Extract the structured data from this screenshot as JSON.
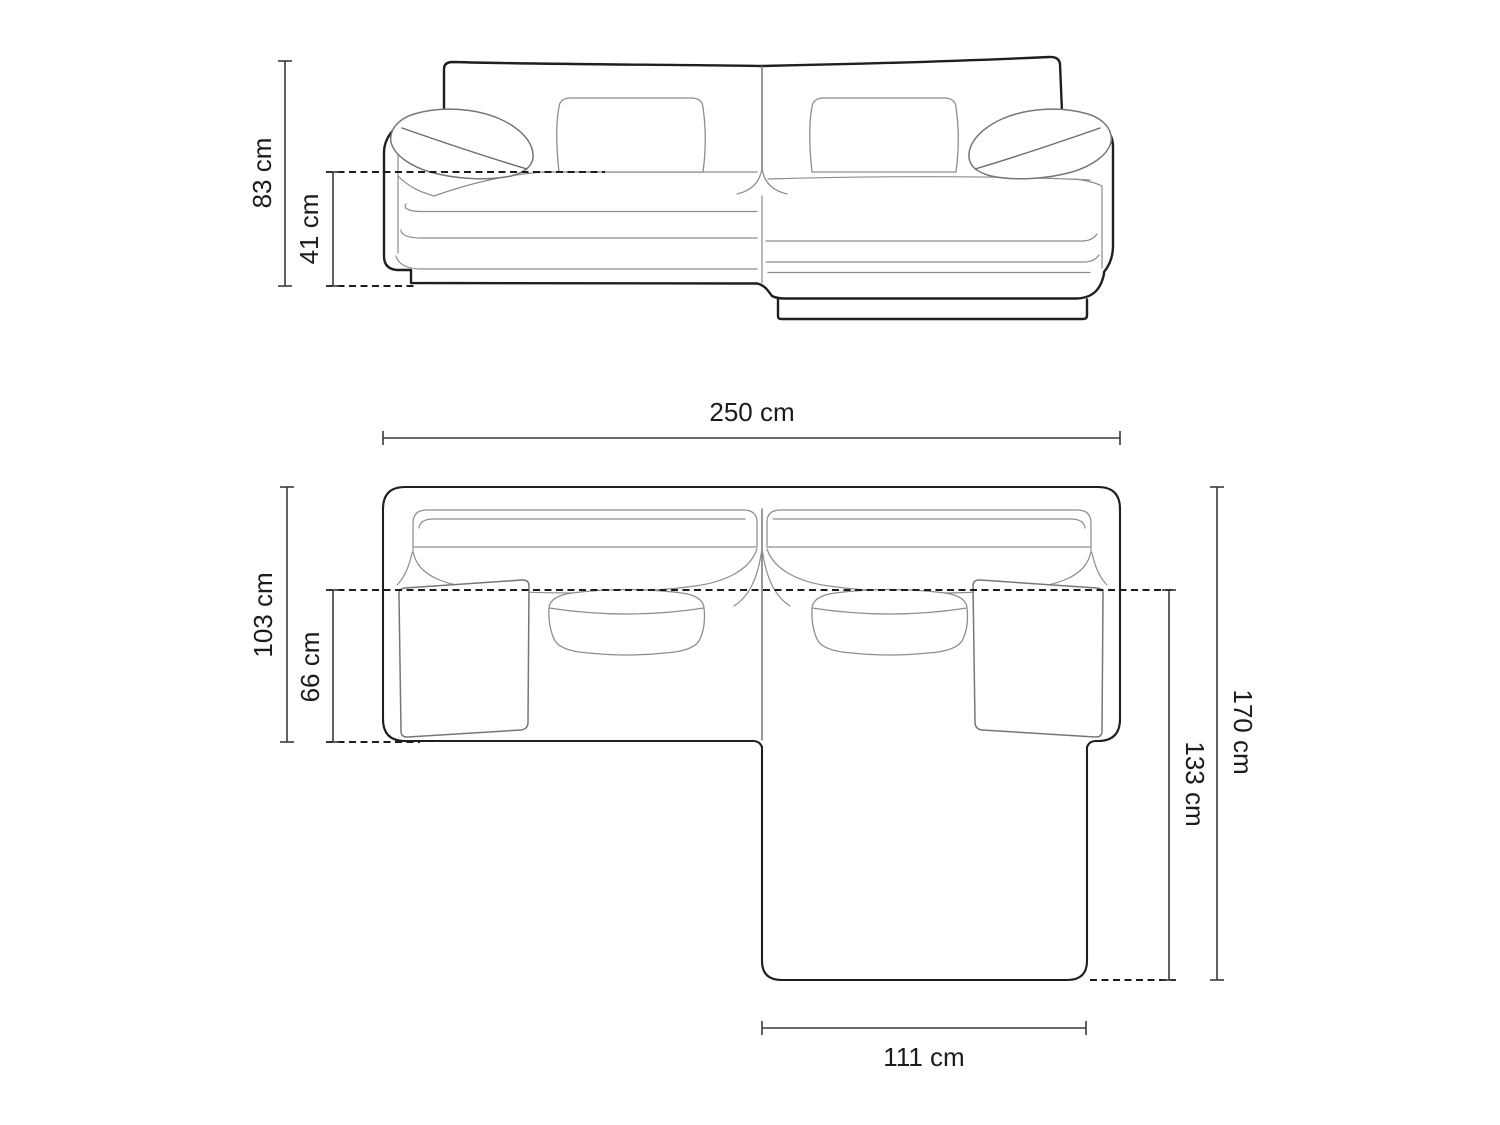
{
  "diagram": {
    "subject": "corner-sofa-dimension-drawing",
    "front_view": {
      "dimensions": {
        "total_height": "83 cm",
        "seat_height": "41 cm"
      }
    },
    "top_view": {
      "dimensions": {
        "total_width": "250 cm",
        "body_depth": "103 cm",
        "seat_depth": "66 cm",
        "total_depth": "170 cm",
        "chaise_depth": "133 cm",
        "chaise_width": "111 cm"
      }
    },
    "colors": {
      "background": "#ffffff",
      "outline": "#1f1f1f",
      "detail": "#8d8d8d",
      "dimension": "#3a3a3a",
      "text": "#1c1c1c"
    }
  }
}
